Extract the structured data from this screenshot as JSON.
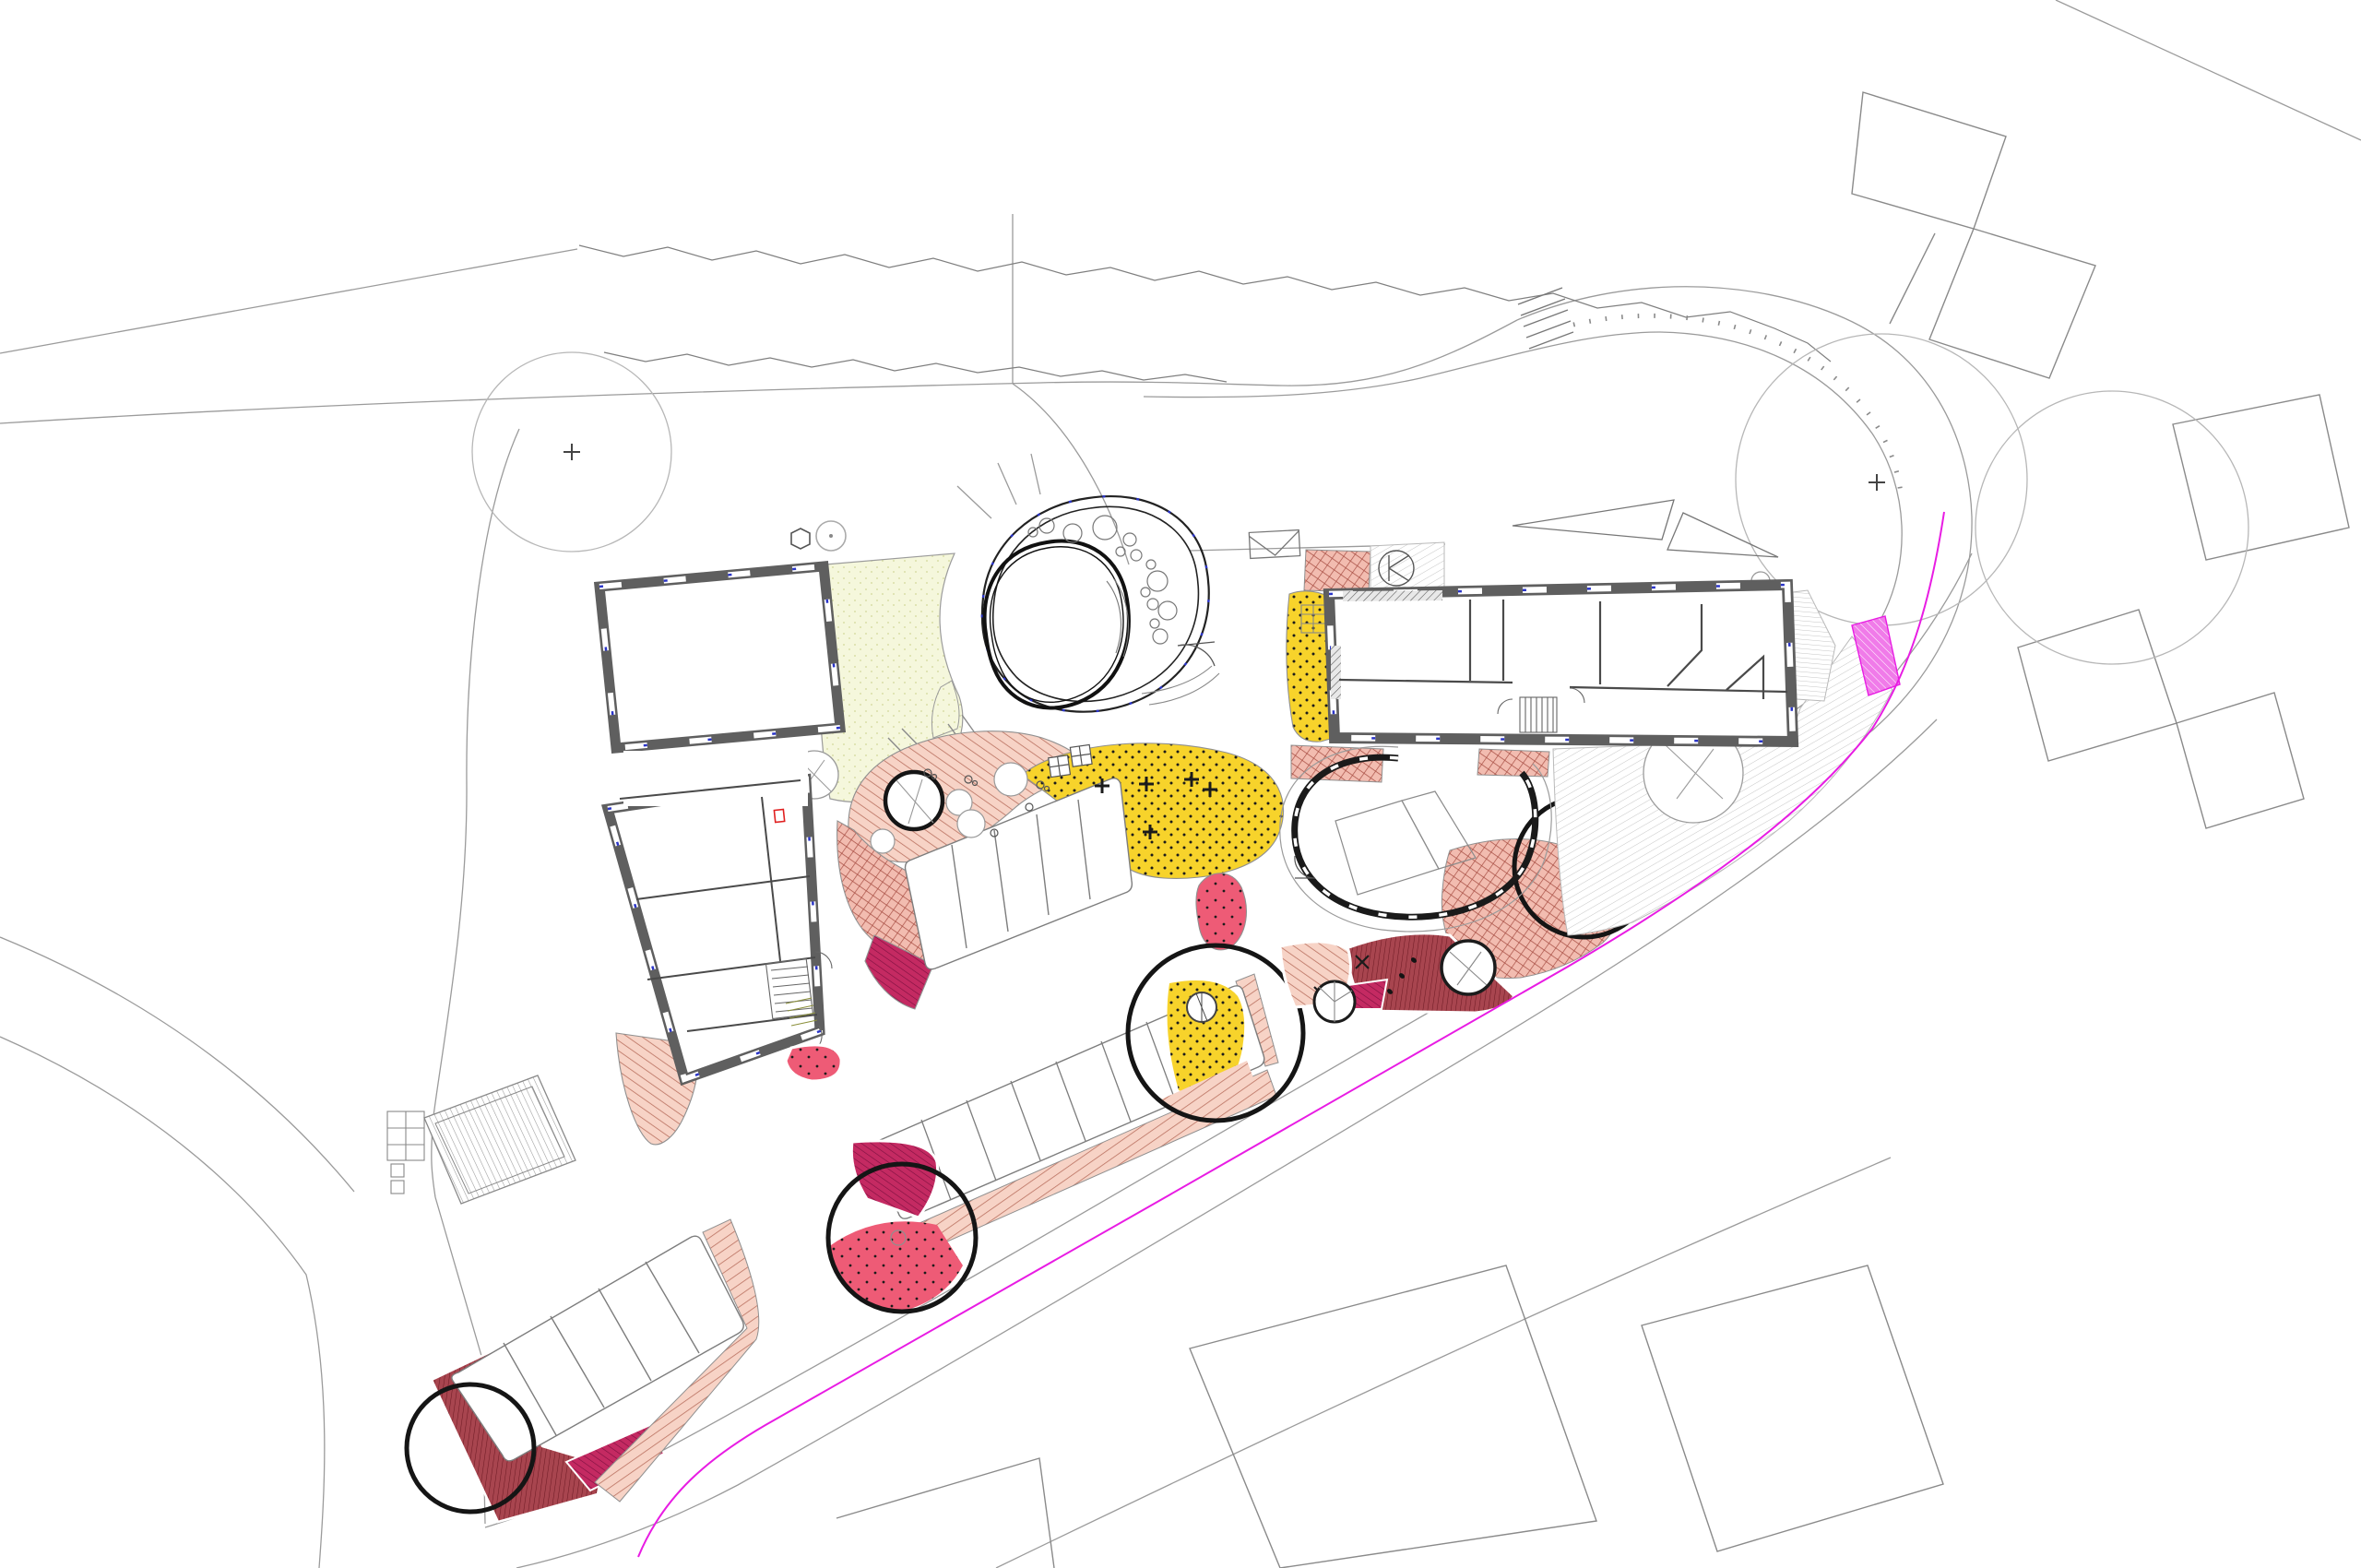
{
  "drawing": {
    "kind": "architectural-site-plan",
    "orientation": "plan-view",
    "background": "#ffffff"
  },
  "colors": {
    "wall": "#5f5f5f",
    "wallDark": "#1a1a1a",
    "partition": "#4a4a4a",
    "line": "#9b9b9b",
    "lineDark": "#6f6f6f",
    "salmonFill": "#f7d3c6",
    "salmonLine": "#b9705f",
    "gridFill": "#f2bcb0",
    "gridLine": "#a84f44",
    "crimsonFill": "#c42a62",
    "crimsonLine": "#7c0f3f",
    "darkredFill": "#a8454f",
    "darkredLine": "#6e1a24",
    "reddotFill": "#ee5b76",
    "dotColor": "#1b1b1b",
    "yellowFill": "#f7d32b",
    "paleFill": "#f5f7dc",
    "paleDot": "#d9dfa8",
    "plazaLine": "#c6c6c6",
    "stripeLine": "#9a9a9a",
    "violetFill": "#f07be9",
    "magenta": "#e81ce3",
    "blueTick": "#2b35c8",
    "treeRing": "#151515",
    "redMarker": "#e02020",
    "white": "#ffffff"
  },
  "features": {
    "buildings": [
      {
        "id": "building-west",
        "form": "L-shaped, square hall with south wing, thick walls with window openings"
      },
      {
        "id": "building-east",
        "form": "long rectangular block, four rooms plus corridor and stair"
      },
      {
        "id": "round-pavilion",
        "form": "egg-shaped double-ring pavilion with inner oval room and pebble circles"
      }
    ],
    "parkingRows": [
      {
        "id": "central-upper-row",
        "stalls": 5
      },
      {
        "id": "central-lower-row",
        "stalls": 8
      },
      {
        "id": "southwest-row",
        "stalls": 5
      }
    ],
    "zones": [
      {
        "id": "play-surface-salmon",
        "pattern": "diagonal-hatch"
      },
      {
        "id": "play-surface-crosshatch",
        "pattern": "grid-hatch"
      },
      {
        "id": "play-surface-crimson",
        "pattern": "diagonal-hatch-dense"
      },
      {
        "id": "play-surface-darkred",
        "pattern": "vertical-hatch"
      },
      {
        "id": "play-surface-red-dotted",
        "pattern": "dots"
      },
      {
        "id": "play-surface-yellow-dotted",
        "pattern": "dots-plus-marks"
      },
      {
        "id": "terrace-pale-yellow",
        "pattern": "fine-dots"
      },
      {
        "id": "plaza-hatched",
        "pattern": "thin-diagonal-lines"
      },
      {
        "id": "violet-strip",
        "pattern": "diagonal-hatch"
      }
    ],
    "treeSymbols": {
      "largeOutlineCircles": 3,
      "blackRingTrees": 7,
      "whiteCanopyTrees": 9,
      "grayTrees": 2
    },
    "siteLines": {
      "propertyLine": "magenta",
      "vegetationEdge": "jagged",
      "roads": "thin gray double lines"
    },
    "smallSymbols": [
      "hexagon-bollard",
      "manhole-circle-k",
      "grate-rectangle",
      "sandbox-squares",
      "footstep-dots",
      "stair-runs"
    ]
  }
}
